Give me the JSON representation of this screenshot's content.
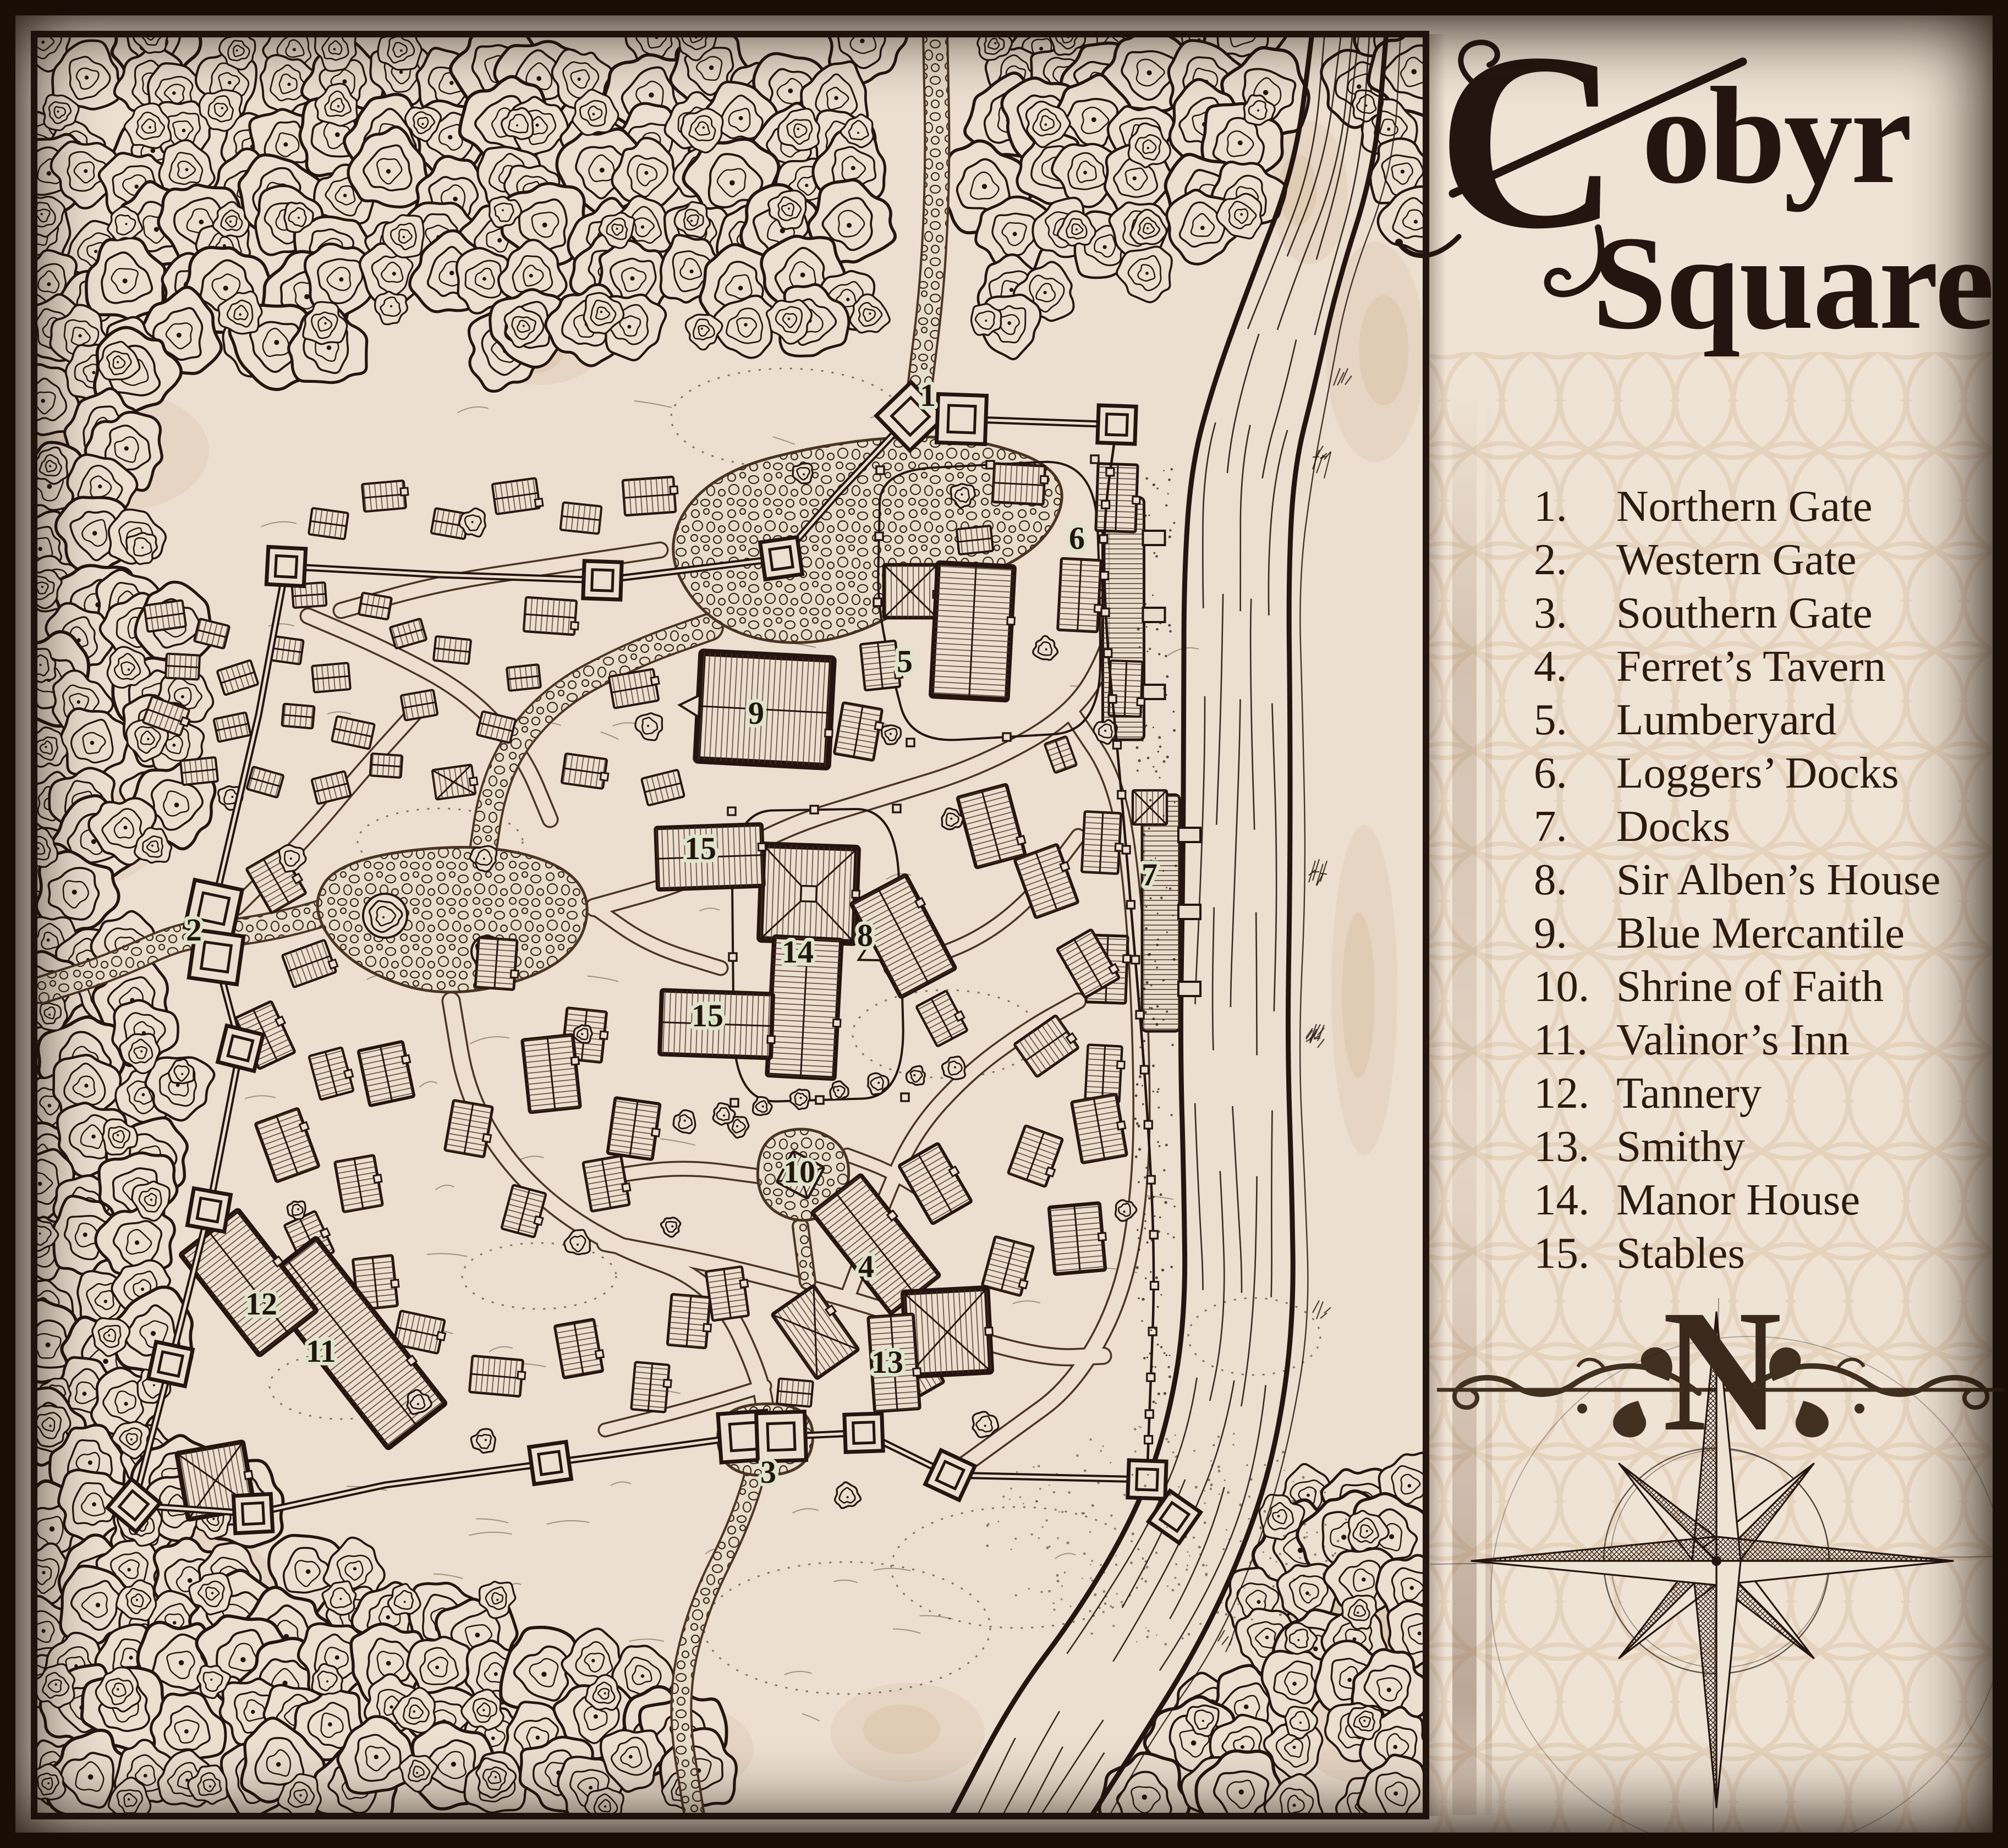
{
  "title": {
    "initial": "C",
    "line1_rest": "obyr",
    "line2": "Square"
  },
  "legend": {
    "items": [
      {
        "num": "1.",
        "label": "Northern Gate"
      },
      {
        "num": "2.",
        "label": "Western Gate"
      },
      {
        "num": "3.",
        "label": "Southern Gate"
      },
      {
        "num": "4.",
        "label": "Ferret’s Tavern"
      },
      {
        "num": "5.",
        "label": "Lumberyard"
      },
      {
        "num": "6.",
        "label": "Loggers’ Docks"
      },
      {
        "num": "7.",
        "label": "Docks"
      },
      {
        "num": "8.",
        "label": "Sir Alben’s House"
      },
      {
        "num": "9.",
        "label": "Blue Mercantile"
      },
      {
        "num": "10.",
        "label": "Shrine of Faith"
      },
      {
        "num": "11.",
        "label": "Valinor’s Inn"
      },
      {
        "num": "12.",
        "label": "Tannery"
      },
      {
        "num": "13.",
        "label": "Smithy"
      },
      {
        "num": "14.",
        "label": "Manor House"
      },
      {
        "num": "15.",
        "label": "Stables"
      }
    ]
  },
  "compass": {
    "north_letter": "N"
  },
  "map": {
    "labels": [
      {
        "text": "1"
      },
      {
        "text": "2"
      },
      {
        "text": "3"
      },
      {
        "text": "4"
      },
      {
        "text": "5"
      },
      {
        "text": "6"
      },
      {
        "text": "7"
      },
      {
        "text": "8"
      },
      {
        "text": "9"
      },
      {
        "text": "10"
      },
      {
        "text": "11"
      },
      {
        "text": "12"
      },
      {
        "text": "13"
      },
      {
        "text": "14"
      },
      {
        "text": "15"
      },
      {
        "text": "15"
      }
    ]
  },
  "colors": {
    "ink": "#241510",
    "parchment": "#ecdfd0",
    "sidebar": "#efe3d5",
    "halo": "#dde4c9",
    "accent": "#4a372a"
  }
}
